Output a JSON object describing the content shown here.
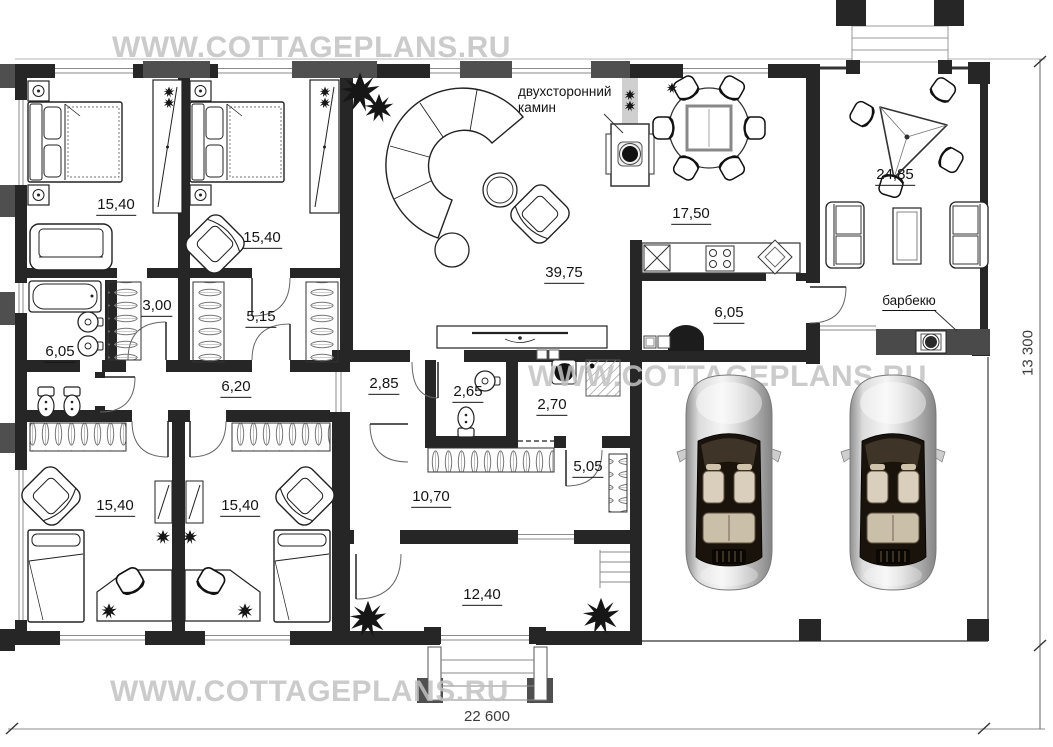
{
  "watermarks": {
    "top": "WWW.COTTAGEPLANS.RU",
    "middle": "WWW.COTTAGEPLANS.RU",
    "bottom": "WWW.COTTAGEPLANS.RU"
  },
  "dimensions": {
    "overall_width": "22 600",
    "overall_depth": "13 300"
  },
  "annotations": {
    "fireplace_line1": "двухсторонний",
    "fireplace_line2": "камин",
    "barbecue": "барбекю"
  },
  "rooms": {
    "bedroom1": {
      "area": "15,40"
    },
    "bedroom2": {
      "area": "15,40"
    },
    "closet1": {
      "area": "3,00"
    },
    "closet2": {
      "area": "5,15"
    },
    "bathroom": {
      "area": "6,05"
    },
    "hallway": {
      "area": "6,20"
    },
    "vestibule": {
      "area": "2,85"
    },
    "wc": {
      "area": "2,65"
    },
    "laundry": {
      "area": "2,70"
    },
    "living": {
      "area": "39,75"
    },
    "kitchen": {
      "area": "17,50"
    },
    "mudroom": {
      "area": "6,05"
    },
    "terrace": {
      "area": "24,85"
    },
    "hall": {
      "area": "5,05"
    },
    "corridor": {
      "area": "10,70"
    },
    "entry": {
      "area": "12,40"
    },
    "kids1": {
      "area": "15,40"
    },
    "kids2": {
      "area": "15,40"
    }
  },
  "colors": {
    "wall": "#262626",
    "pilaster": "#4f4f4f",
    "barbecue_wall": "#4a4a4a",
    "watermark": "#c2c2c2"
  }
}
